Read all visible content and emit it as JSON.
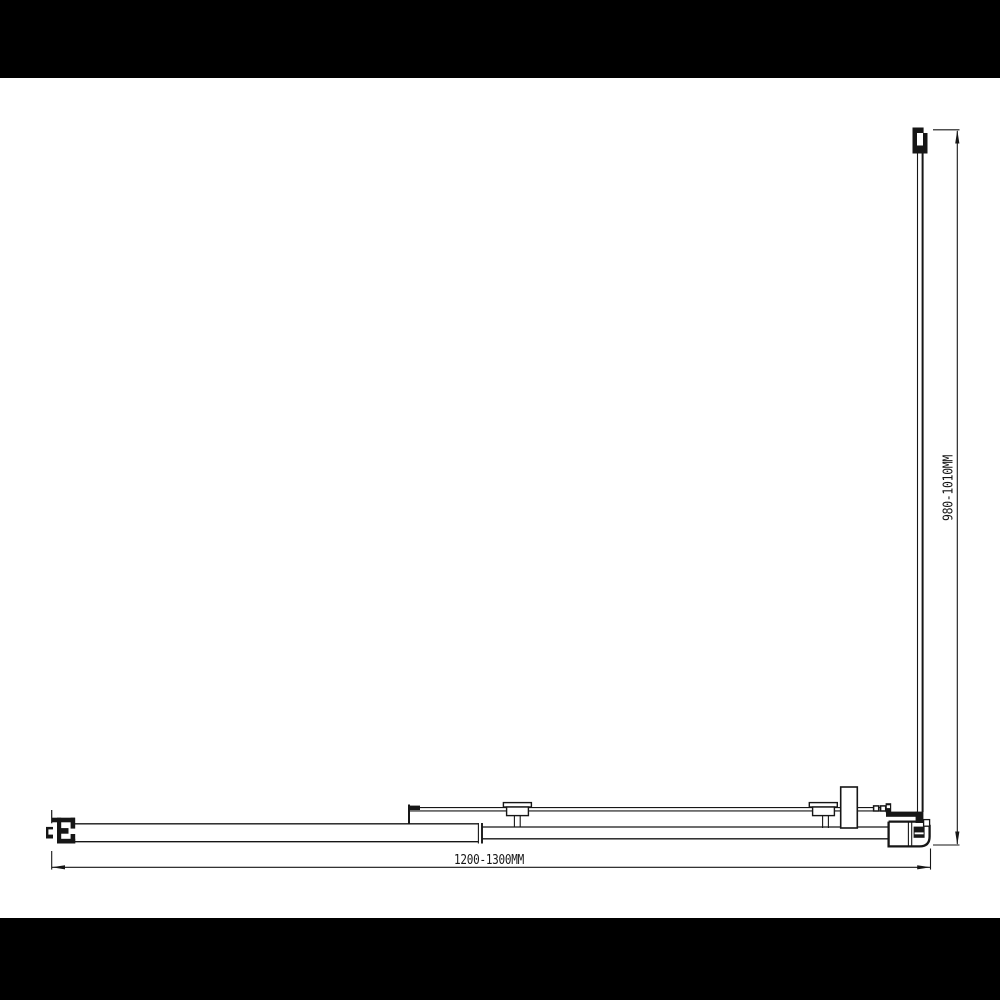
{
  "page": {
    "letterbox_color": "#000000",
    "canvas_color": "#ffffff",
    "line_color": "#161616"
  },
  "drawing": {
    "type": "technical-plan-diagram",
    "dimensions": {
      "width": {
        "label": "1200-1300MM"
      },
      "depth": {
        "label": "980-1010MM"
      }
    }
  }
}
